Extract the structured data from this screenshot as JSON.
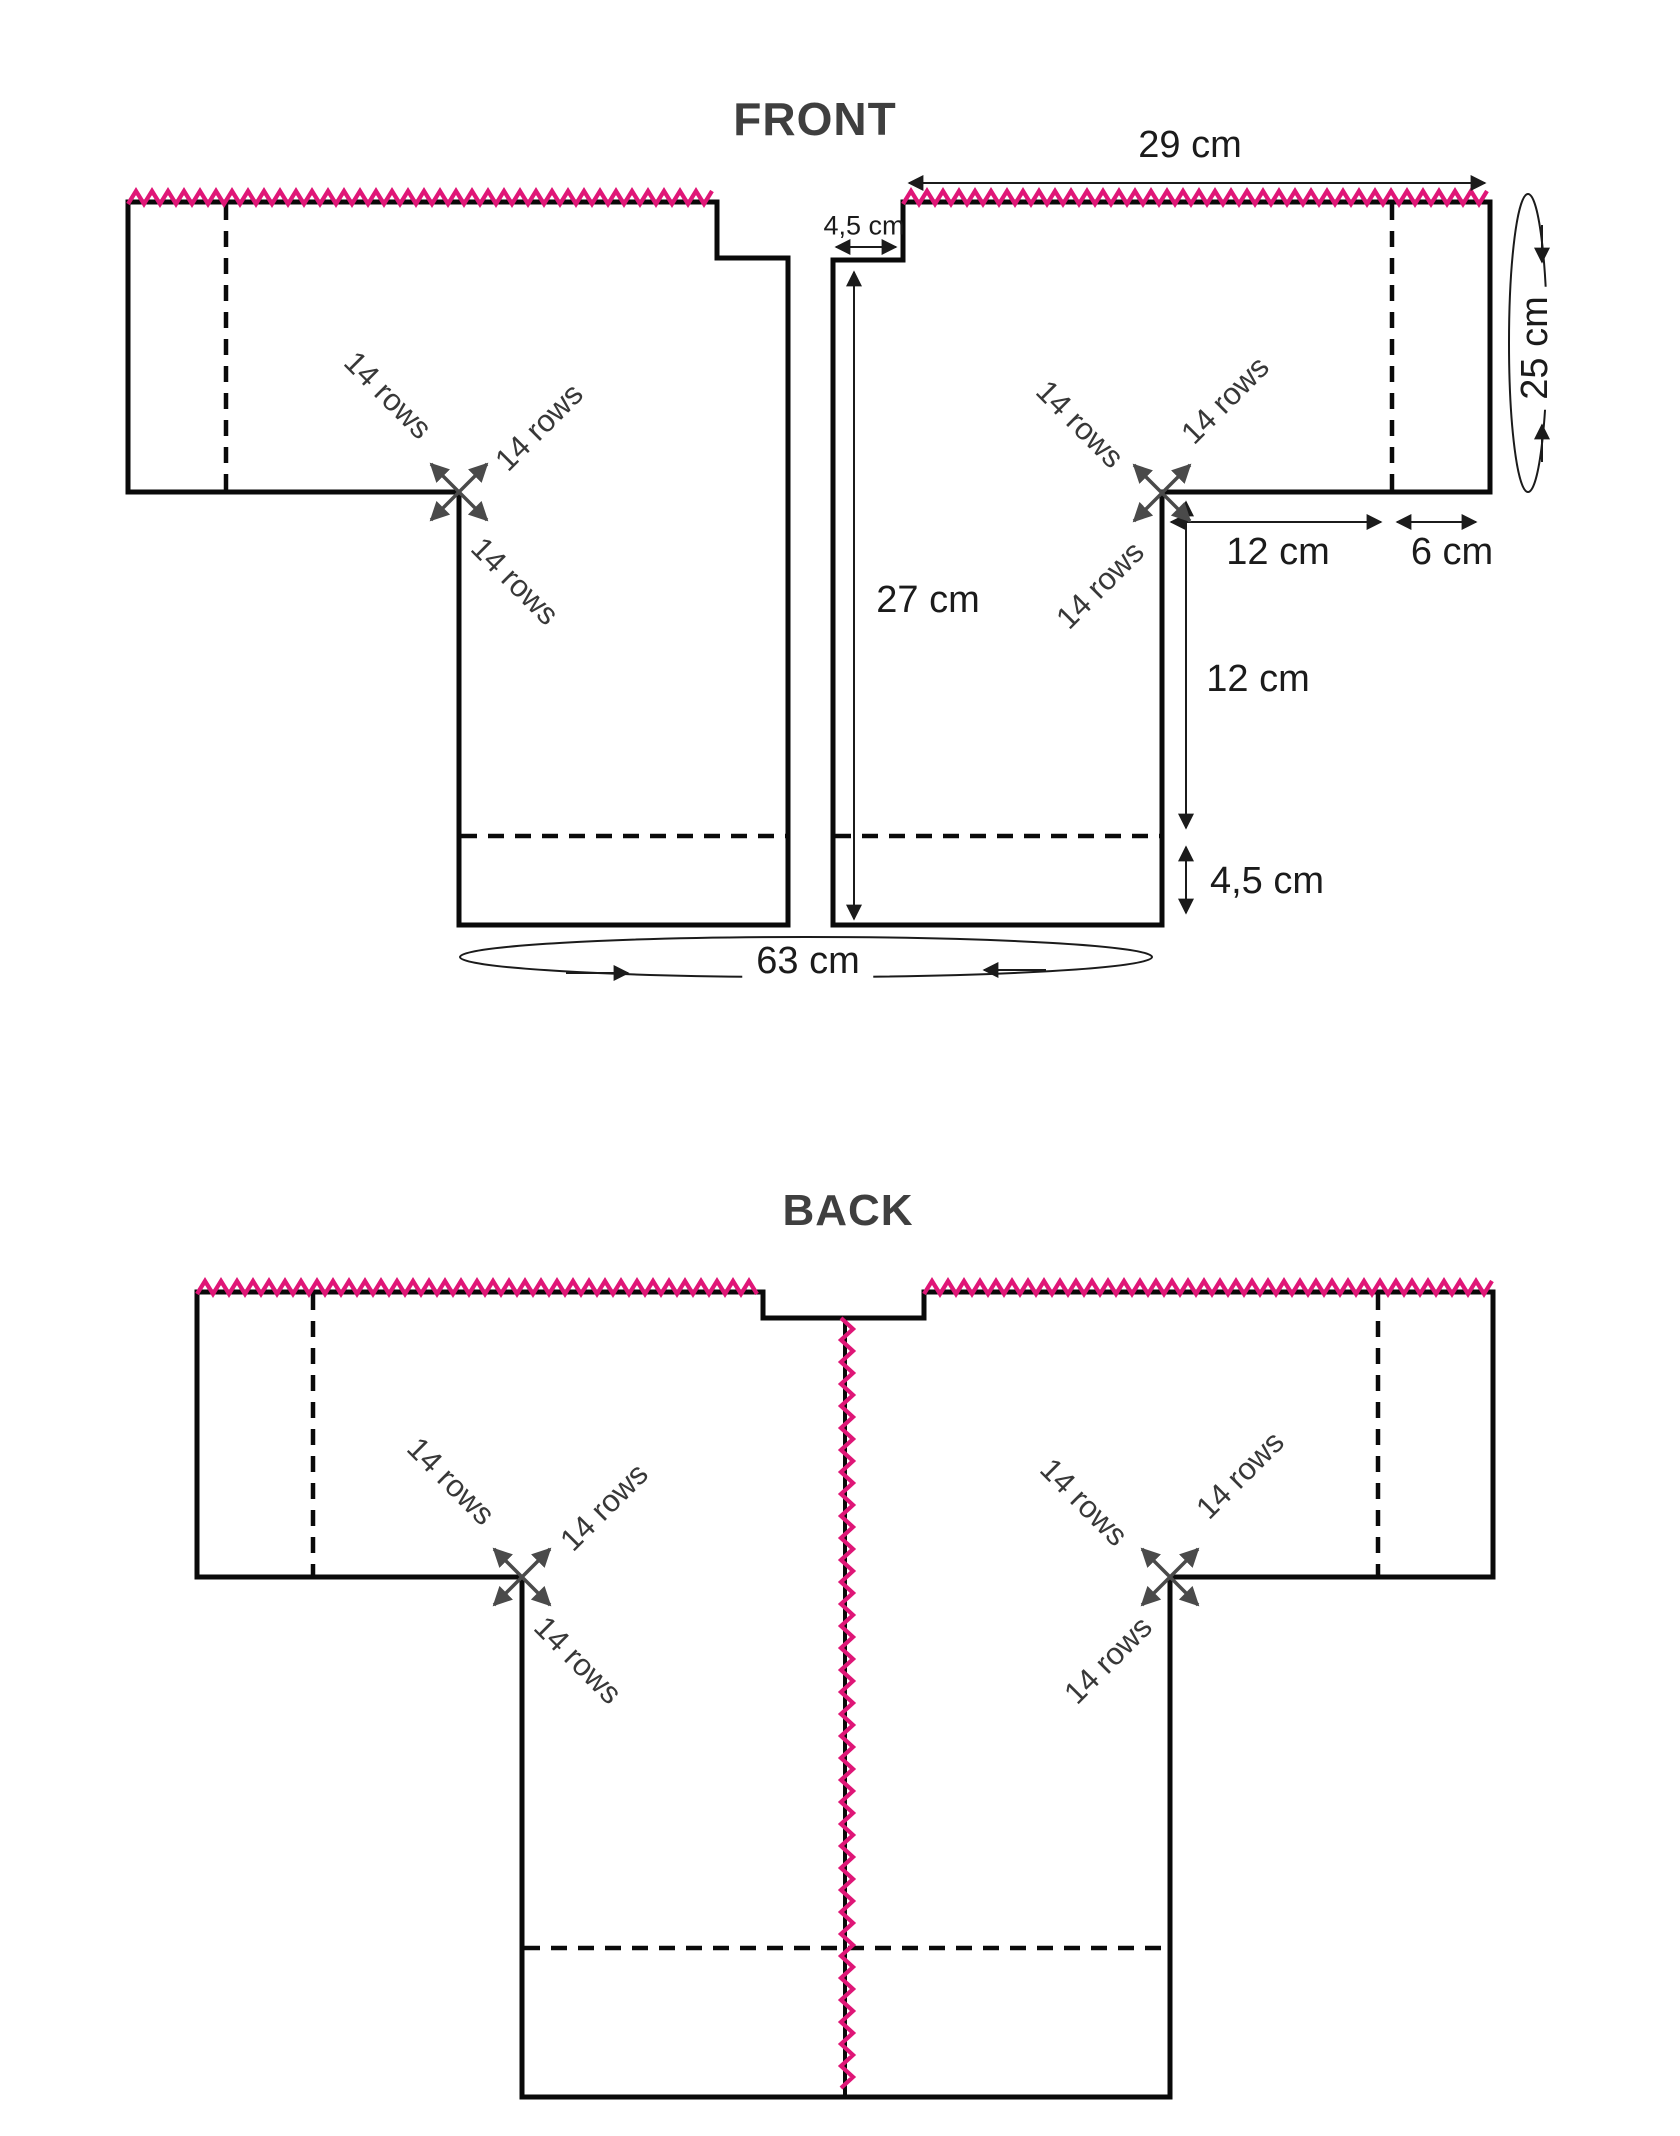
{
  "front": {
    "title": "FRONT",
    "dims": {
      "top_width": "29 cm",
      "neck_offset": "4,5 cm",
      "length": "27 cm",
      "underarm_inner": "12 cm",
      "underarm_outer": "6 cm",
      "side": "12 cm",
      "hem": "4,5 cm",
      "bottom_width": "63 cm",
      "sleeve_edge": "25 cm"
    }
  },
  "back": {
    "title": "BACK"
  },
  "shared": {
    "rows_label": "14 rows"
  },
  "colors": {
    "zigzag": "#df1677",
    "outline": "#0a0a0a",
    "title": "#3f3f3f",
    "dimension_text": "#1b1b1b",
    "rows_text": "#383838",
    "corner_arrows": "#4a4a4a",
    "background": "#ffffff"
  }
}
